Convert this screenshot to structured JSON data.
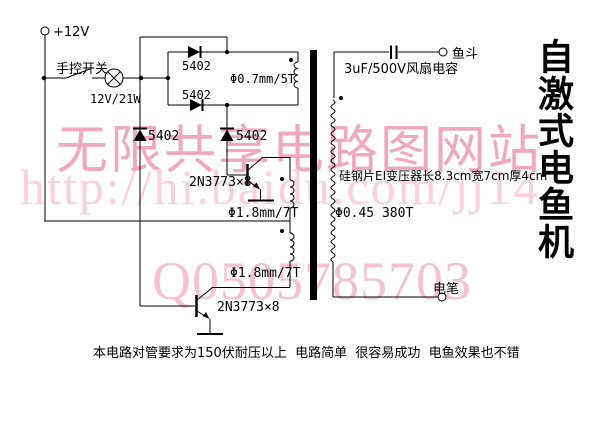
{
  "title": "自激式电鱼机",
  "watermarks": {
    "row1": "无限共享电路图网站",
    "row2": "http://hi.baidu.com/jj14",
    "row3": "Q0505785703"
  },
  "labels": {
    "supply": "+12V",
    "manual_switch": "手控开关",
    "lamp": "12V/21W",
    "diode_box_top": "5402",
    "diode_box_bottom": "5402",
    "feedback_winding": "Φ0.7mm/5T",
    "diode_left": "5402",
    "diode_right": "5402",
    "transistor_upper": "2N3773×8",
    "primary_winding_upper": "Φ1.8mm/7T",
    "primary_winding_lower": "Φ1.8mm/7T",
    "transistor_lower": "2N3773×8",
    "capacitor": "3uF/500V风扇电容",
    "output_fish_bucket": "鱼斗",
    "transformer_core_note": "硅钢片EI变压器长8.3cm宽7cm厚4cm",
    "secondary_winding": "Φ0.45 380T",
    "output_electro_pen": "电笔",
    "bottom_note": "本电路对管要求为150伏耐压以上  电路简单  很容易成功  电鱼效果也不错"
  },
  "colors": {
    "line": "#000000",
    "background": "#ffffff",
    "watermark_row1": "#f0a9bc",
    "watermark_row2": "#f8d3dc",
    "watermark_row3": "#f4c3cf"
  }
}
